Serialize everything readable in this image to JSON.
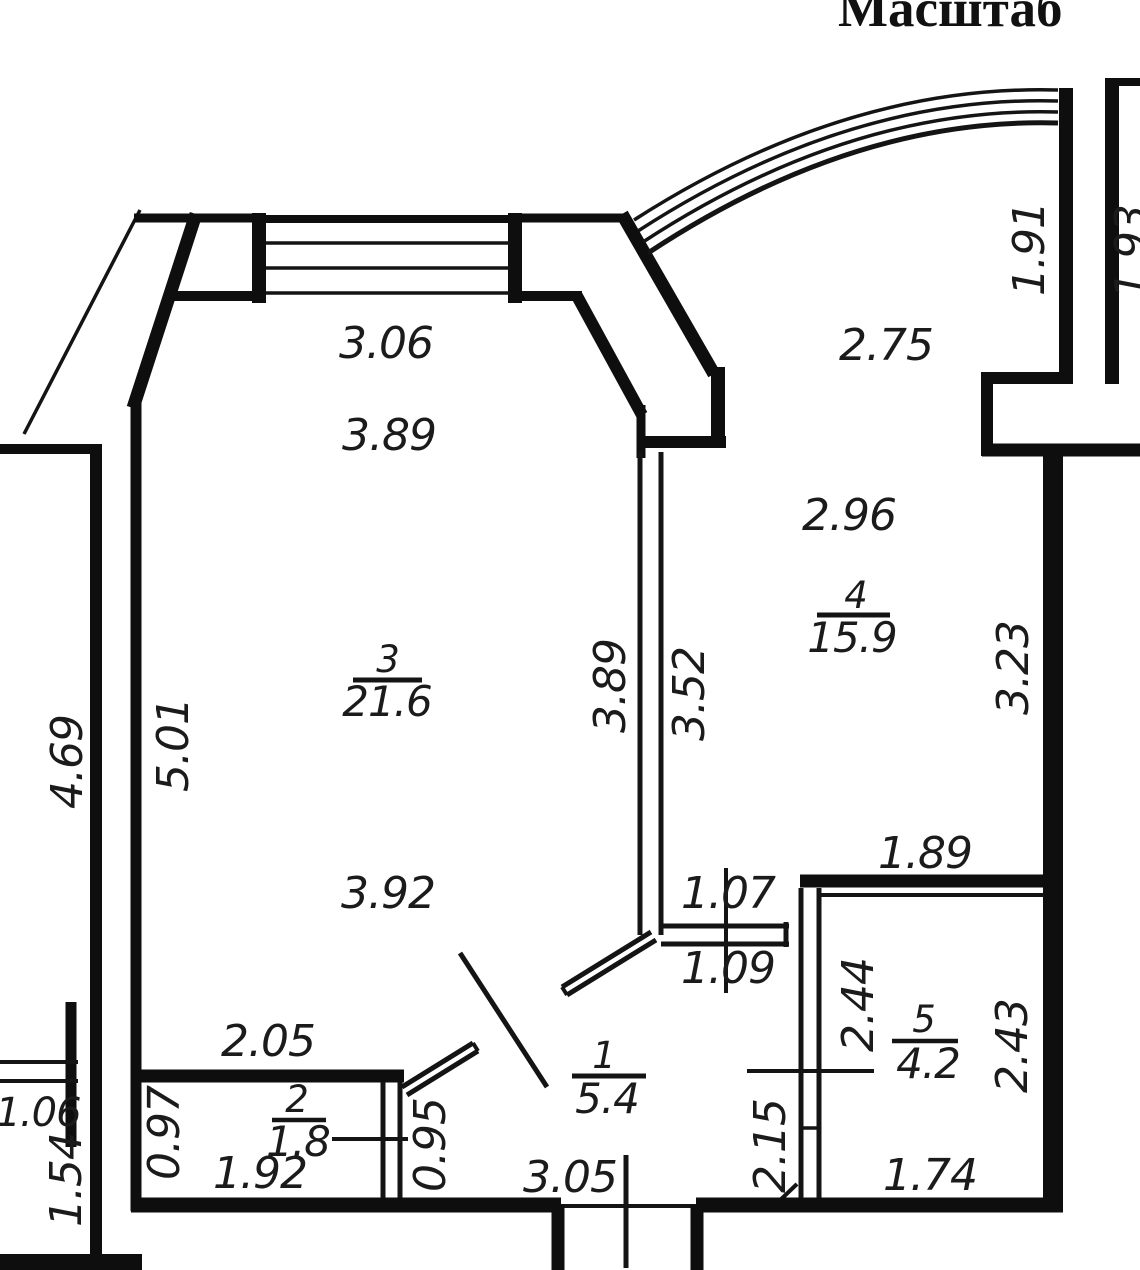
{
  "title": {
    "text": "Масштаб"
  },
  "rooms": {
    "r1": {
      "number": "1",
      "area": "5.4"
    },
    "r2": {
      "number": "2",
      "area": "1.8"
    },
    "r3": {
      "number": "3",
      "area": "21.6"
    },
    "r4": {
      "number": "4",
      "area": "15.9"
    },
    "r5": {
      "number": "5",
      "area": "4.2"
    }
  },
  "dims": {
    "w306": "3.06",
    "w389h": "3.89",
    "w275": "2.75",
    "w191": "1.91",
    "w193": "1.93",
    "w296": "2.96",
    "w389v": "3.89",
    "w352": "3.52",
    "w323": "3.23",
    "w469": "4.69",
    "w501": "5.01",
    "w392": "3.92",
    "w189": "1.89",
    "w107": "1.07",
    "w109": "1.09",
    "w244": "2.44",
    "w243": "2.43",
    "w215": "2.15",
    "w174": "1.74",
    "w205": "2.05",
    "w106": "1.06",
    "w154": "1.54",
    "w097": "0.97",
    "w192": "1.92",
    "w095": "0.95",
    "w305": "3.05"
  },
  "colors": {
    "wall": "#0e0e0e",
    "label": "#1b1b1b",
    "background": "#ffffff"
  }
}
